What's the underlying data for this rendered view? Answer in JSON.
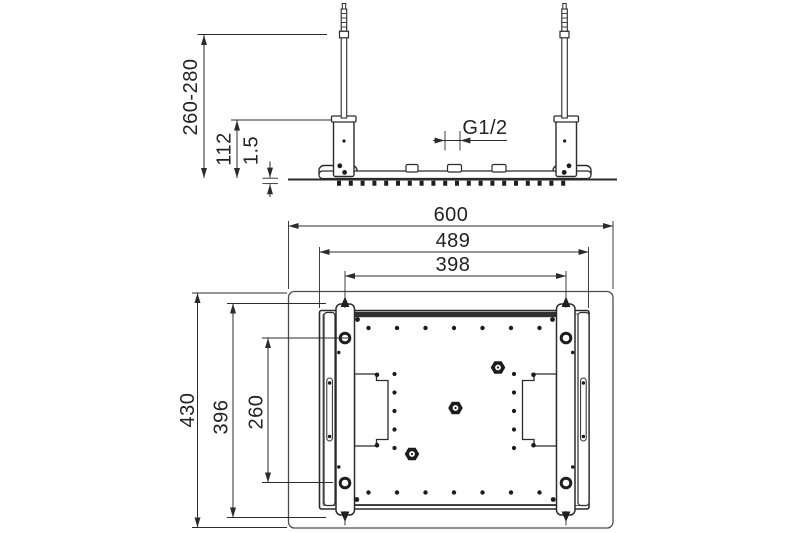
{
  "drawing": {
    "type": "technical-dimension-drawing",
    "line_color": "#2b2b2b",
    "background_color": "#ffffff",
    "side_view": {
      "height_range": "260-280",
      "bracket_height": "112",
      "plate_thickness": "1.5",
      "inlet_thread": "G1/2"
    },
    "plan_view": {
      "overall_width": "600",
      "plate_width": "489",
      "mount_spacing_width": "398",
      "overall_depth": "430",
      "rail_length": "396",
      "mount_spacing_depth": "260"
    }
  }
}
